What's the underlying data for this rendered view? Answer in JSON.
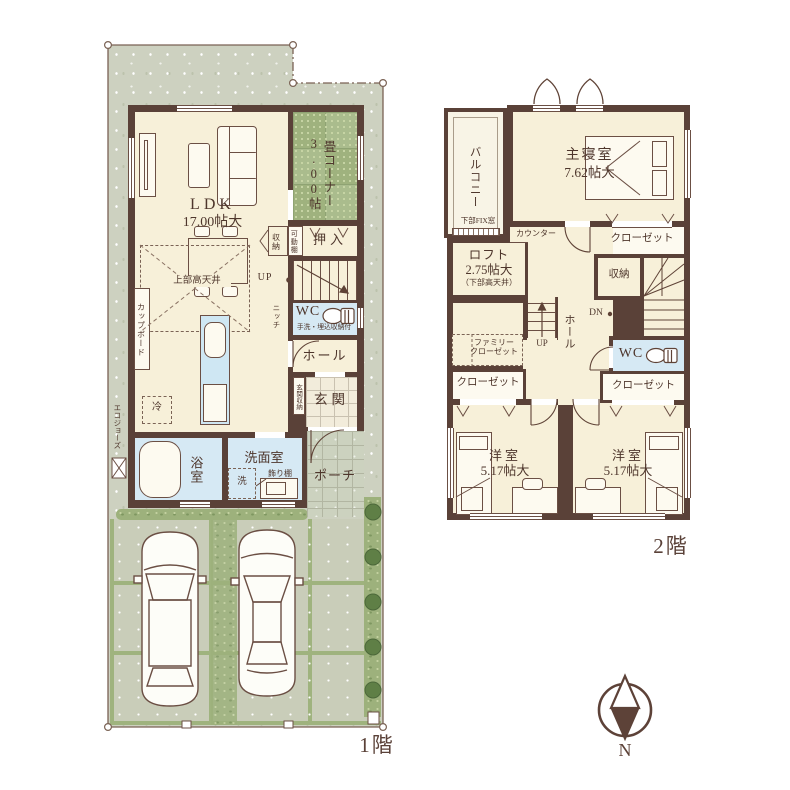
{
  "floor1": {
    "floor_label": "1階",
    "ldk_name": "LDK",
    "ldk_size": "17.00帖大",
    "tatami_name": "畳コーナー",
    "tatami_size": "3.00帖",
    "high_ceiling": "上部高天井",
    "cupboard": "カップボード",
    "fridge": "冷",
    "storage": "収納",
    "movable_shelf": "可動棚",
    "oshiire": "押入",
    "up": "UP",
    "niche": "ニッチ",
    "wc_name": "WC",
    "wc_note": "手洗・埋込収納付",
    "hall": "ホール",
    "entrance_storage": "玄関収納",
    "entrance": "玄関",
    "porch": "ポーチ",
    "bath": "浴室",
    "washroom": "洗面室",
    "washer": "洗",
    "deco_shelf": "飾り棚",
    "eco": "エコジョーズ"
  },
  "floor2": {
    "floor_label": "2階",
    "balcony": "バルコニー",
    "fix_window": "下部FIX窓",
    "master_name": "主寝室",
    "master_size": "7.62帖大",
    "counter": "カウンター",
    "closet_master": "クローゼット",
    "loft_name": "ロフト",
    "loft_size": "2.75帖大",
    "loft_note": "（下部高天井）",
    "storage": "収納",
    "hall": "ホール",
    "dn": "DN",
    "up": "UP",
    "family_closet_line1": "ファミリー",
    "family_closet_line2": "クローゼット",
    "wc": "WC",
    "closet_west": "クローゼット",
    "closet_east": "クローゼット",
    "west_room_name": "洋室",
    "west_room_size": "5.17帖大",
    "east_room_name": "洋室",
    "east_room_size": "5.17帖大"
  },
  "compass_n": "N"
}
